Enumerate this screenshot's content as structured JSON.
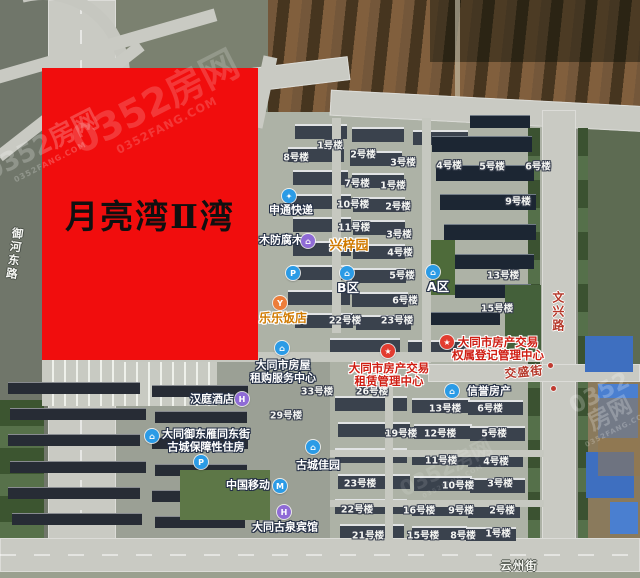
{
  "map": {
    "project_overlay": {
      "title": "月亮湾Ⅱ湾",
      "bg_color": "#f10d0d",
      "text_color": "#101010",
      "x": 42,
      "y": 68,
      "width": 216,
      "height": 292
    },
    "watermark": {
      "text": "0352房网",
      "subtext": "0352FANG.COM",
      "instances": [
        {
          "x": 158,
          "y": 108,
          "size": 38,
          "opacity": 0.4,
          "rot": -27
        },
        {
          "x": 44,
          "y": 150,
          "size": 26,
          "opacity": 0.5,
          "rot": -27
        },
        {
          "x": 607,
          "y": 408,
          "size": 23,
          "opacity": 0.5,
          "rot": -27
        },
        {
          "x": 448,
          "y": 472,
          "size": 21,
          "opacity": 0.25,
          "rot": -27
        }
      ]
    },
    "road_labels": [
      {
        "id": "yuhe-east-road",
        "name": "御河东路",
        "orientation": "vertical",
        "style": "white",
        "x": 14,
        "y": 254,
        "rot": 8
      },
      {
        "id": "wenxing-road",
        "name": "文兴路",
        "orientation": "vertical",
        "style": "red",
        "x": 557,
        "y": 312,
        "rot": 0
      },
      {
        "id": "jiaosheng-street",
        "name": "交盛街",
        "orientation": "horizontal",
        "style": "red",
        "x": 524,
        "y": 373,
        "rot": -5
      },
      {
        "id": "yunzhou-street",
        "name": "云州街",
        "orientation": "horizontal",
        "style": "white",
        "x": 519,
        "y": 566,
        "rot": 0
      }
    ],
    "building_labels": [
      {
        "label": "1号楼",
        "x": 330,
        "y": 147
      },
      {
        "label": "2号楼",
        "x": 363,
        "y": 156
      },
      {
        "label": "8号楼",
        "x": 296,
        "y": 159
      },
      {
        "label": "3号楼",
        "x": 403,
        "y": 164
      },
      {
        "label": "4号楼",
        "x": 449,
        "y": 167
      },
      {
        "label": "5号楼",
        "x": 492,
        "y": 168
      },
      {
        "label": "6号楼",
        "x": 538,
        "y": 168
      },
      {
        "label": "7号楼",
        "x": 357,
        "y": 185
      },
      {
        "label": "1号楼",
        "x": 393,
        "y": 187
      },
      {
        "label": "10号楼",
        "x": 353,
        "y": 206
      },
      {
        "label": "2号楼",
        "x": 398,
        "y": 208
      },
      {
        "label": "9号楼",
        "x": 518,
        "y": 203
      },
      {
        "label": "11号楼",
        "x": 354,
        "y": 229
      },
      {
        "label": "3号楼",
        "x": 399,
        "y": 236
      },
      {
        "label": "4号楼",
        "x": 400,
        "y": 254
      },
      {
        "label": "5号楼",
        "x": 402,
        "y": 277
      },
      {
        "label": "13号楼",
        "x": 503,
        "y": 277
      },
      {
        "label": "6号楼",
        "x": 405,
        "y": 302
      },
      {
        "label": "15号楼",
        "x": 497,
        "y": 310
      },
      {
        "label": "22号楼",
        "x": 345,
        "y": 322
      },
      {
        "label": "23号楼",
        "x": 397,
        "y": 322
      },
      {
        "label": "33号楼",
        "x": 317,
        "y": 393
      },
      {
        "label": "26号楼",
        "x": 372,
        "y": 393
      },
      {
        "label": "29号楼",
        "x": 286,
        "y": 417
      },
      {
        "label": "13号楼",
        "x": 445,
        "y": 410
      },
      {
        "label": "6号楼",
        "x": 490,
        "y": 410
      },
      {
        "label": "19号楼",
        "x": 401,
        "y": 435
      },
      {
        "label": "12号楼",
        "x": 440,
        "y": 435
      },
      {
        "label": "5号楼",
        "x": 494,
        "y": 435
      },
      {
        "label": "11号楼",
        "x": 441,
        "y": 462
      },
      {
        "label": "4号楼",
        "x": 496,
        "y": 463
      },
      {
        "label": "23号楼",
        "x": 360,
        "y": 485
      },
      {
        "label": "10号楼",
        "x": 458,
        "y": 487
      },
      {
        "label": "3号楼",
        "x": 500,
        "y": 485
      },
      {
        "label": "22号楼",
        "x": 357,
        "y": 511
      },
      {
        "label": "16号楼",
        "x": 419,
        "y": 512
      },
      {
        "label": "9号楼",
        "x": 461,
        "y": 512
      },
      {
        "label": "2号楼",
        "x": 502,
        "y": 512
      },
      {
        "label": "21号楼",
        "x": 368,
        "y": 537
      },
      {
        "label": "15号楼",
        "x": 423,
        "y": 537
      },
      {
        "label": "8号楼",
        "x": 463,
        "y": 537
      },
      {
        "label": "1号楼",
        "x": 498,
        "y": 535
      }
    ],
    "poi_labels": [
      {
        "id": "shentong-express",
        "lines": [
          "申通快递"
        ],
        "style": "white",
        "text_x": 291,
        "text_y": 211,
        "icon": {
          "name": "express-icon",
          "glyph": "✦",
          "color": "#2b9be6",
          "x": 289,
          "y": 196
        }
      },
      {
        "id": "anticorrosive-wood",
        "lines": [
          "木防腐木"
        ],
        "style": "white",
        "text_x": 281,
        "text_y": 241
      },
      {
        "id": "xingziyuan",
        "lines": [
          "兴梓园"
        ],
        "style": "orange",
        "text_x": 349,
        "text_y": 247,
        "icon": {
          "name": "estate-icon",
          "glyph": "⌂",
          "color": "#8f6bd6",
          "x": 308,
          "y": 241
        }
      },
      {
        "id": "lele-restaurant",
        "lines": [
          "乐乐饭店"
        ],
        "style": "orange",
        "size": 12,
        "text_x": 283,
        "text_y": 319,
        "icon": {
          "name": "restaurant-icon",
          "glyph": "Y",
          "color": "#ed7d3a",
          "x": 280,
          "y": 303
        }
      },
      {
        "id": "zone-b",
        "lines": [
          "B区"
        ],
        "style": "white",
        "area": true,
        "text_x": 348,
        "text_y": 288,
        "icon": {
          "name": "zone-icon",
          "glyph": "⌂",
          "color": "#2b9be6",
          "x": 347,
          "y": 273
        }
      },
      {
        "id": "zone-a",
        "lines": [
          "A区"
        ],
        "style": "white",
        "area": true,
        "text_x": 438,
        "text_y": 287,
        "icon": {
          "name": "zone-icon",
          "glyph": "⌂",
          "color": "#2b9be6",
          "x": 433,
          "y": 272
        }
      },
      {
        "id": "parking-north",
        "lines": [],
        "style": "white",
        "text_x": 0,
        "text_y": 0,
        "icon": {
          "name": "parking-icon",
          "glyph": "P",
          "color": "#2b9be6",
          "x": 293,
          "y": 273
        }
      },
      {
        "id": "parking-south",
        "lines": [],
        "style": "white",
        "text_x": 0,
        "text_y": 0,
        "icon": {
          "name": "parking-icon",
          "glyph": "P",
          "color": "#2b9be6",
          "x": 201,
          "y": 462
        }
      },
      {
        "id": "housing-rental-service-center",
        "lines": [
          "大同市房屋",
          "租购服务中心"
        ],
        "style": "white",
        "text_x": 283,
        "text_y": 372,
        "icon": {
          "name": "office-icon",
          "glyph": "⌂",
          "color": "#2b9be6",
          "x": 282,
          "y": 348
        }
      },
      {
        "id": "realty-trade-leasing-center",
        "lines": [
          "大同市房产交易",
          "租赁管理中心"
        ],
        "style": "red",
        "text_x": 389,
        "text_y": 375,
        "icon": {
          "name": "star-icon",
          "glyph": "★",
          "color": "#e23c30",
          "x": 388,
          "y": 351
        }
      },
      {
        "id": "realty-trade-registration-center",
        "lines": [
          "大同市房产交易",
          "权属登记管理中心"
        ],
        "style": "red",
        "text_x": 498,
        "text_y": 349,
        "icon": {
          "name": "star-icon",
          "glyph": "★",
          "color": "#e23c30",
          "x": 447,
          "y": 342
        }
      },
      {
        "id": "xinyu-realty",
        "lines": [
          "信誉房产"
        ],
        "style": "white",
        "text_x": 489,
        "text_y": 392,
        "icon": {
          "name": "agency-icon",
          "glyph": "⌂",
          "color": "#2b9be6",
          "x": 452,
          "y": 391
        }
      },
      {
        "id": "hanting-hotel",
        "lines": [
          "汉庭酒店"
        ],
        "style": "white",
        "text_x": 212,
        "text_y": 400,
        "icon": {
          "name": "hotel-icon",
          "glyph": "H",
          "color": "#8f6bd6",
          "x": 242,
          "y": 399
        }
      },
      {
        "id": "gucheng-subsidized-housing",
        "lines": [
          "大同御东雁同东街",
          "古城保障性住房"
        ],
        "style": "white",
        "text_x": 206,
        "text_y": 441,
        "icon": {
          "name": "housing-icon",
          "glyph": "⌂",
          "color": "#2b9be6",
          "x": 152,
          "y": 436
        }
      },
      {
        "id": "china-mobile",
        "lines": [
          "中国移动"
        ],
        "style": "white",
        "text_x": 248,
        "text_y": 486,
        "icon": {
          "name": "mobile-icon",
          "glyph": "M",
          "color": "#2b9be6",
          "x": 280,
          "y": 486
        }
      },
      {
        "id": "gucheng-jiayuan",
        "lines": [
          "古城佳园"
        ],
        "style": "white",
        "text_x": 318,
        "text_y": 466,
        "icon": {
          "name": "estate-icon",
          "glyph": "⌂",
          "color": "#2b9be6",
          "x": 313,
          "y": 447
        }
      },
      {
        "id": "guquan-hotel",
        "lines": [
          "大同古泉宾馆"
        ],
        "style": "white",
        "text_x": 285,
        "text_y": 528,
        "icon": {
          "name": "hotel-icon",
          "glyph": "H",
          "color": "#8f6bd6",
          "x": 284,
          "y": 512
        }
      }
    ]
  }
}
